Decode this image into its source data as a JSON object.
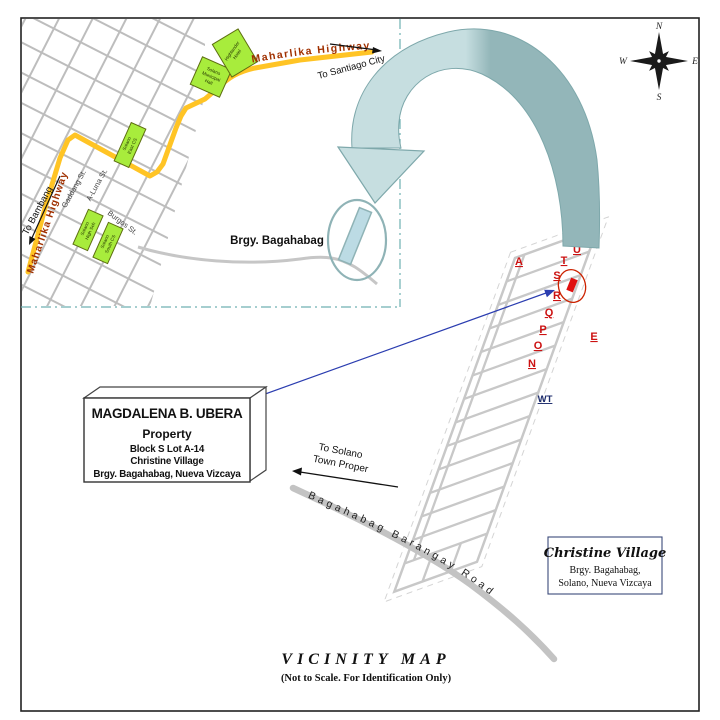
{
  "inset": {
    "maharlika_top": "Maharlika Highway",
    "maharlika_left": "Maharlika Highway",
    "to_santiago": "To Santiago City",
    "to_bambang": "To Bambang",
    "gaddang_st": "Gaddang St.",
    "aluna_st": "A-Luna St.",
    "burgos_st": "Burgos St.",
    "brgy_label": "Brgy. Bagahabag",
    "landmarks": {
      "municipal_hall": [
        "Solano",
        "Municipal",
        "Hall"
      ],
      "hotel": [
        "Highlander",
        "Hotel"
      ],
      "east_cs": [
        "Solano",
        "East CS"
      ],
      "high_school": [
        "Solano",
        "High Sch"
      ],
      "south_cs": [
        "Solano",
        "South CS"
      ]
    }
  },
  "compass": {
    "n": "N",
    "e": "E",
    "s": "S",
    "w": "W"
  },
  "subdivision": {
    "letters": [
      "A",
      "U",
      "T",
      "S",
      "R",
      "Q",
      "P",
      "O",
      "N",
      "E"
    ],
    "wt": "WT"
  },
  "property_box": {
    "owner": "MAGDALENA B. UBERA",
    "type": "Property",
    "lot": "Block S Lot A-14",
    "village": "Christine Village",
    "address": "Brgy. Bagahabag, Nueva Vizcaya"
  },
  "to_solano": {
    "line1": "To Solano",
    "line2": "Town Proper"
  },
  "road_label": "Bagahabag Barangay Road",
  "village_box": {
    "title": "Christine Village",
    "line1": "Brgy. Bagahabag,",
    "line2": "Solano, Nueva Vizcaya"
  },
  "footer": {
    "title": "VICINITY MAP",
    "subtitle": "(Not to Scale. For Identification Only)"
  },
  "colors": {
    "highway_yellow": "#FFC425",
    "landmark_green": "#A8EC3C",
    "ribbon_light": "#C6DEE0",
    "ribbon_dark": "#93B6B9",
    "letter_red": "#CC1111",
    "marker_red": "#E01010",
    "arrow_blue": "#2B3DB0",
    "road_gray": "#C6C6C6",
    "inset_border_teal": "#6FB0B2"
  }
}
